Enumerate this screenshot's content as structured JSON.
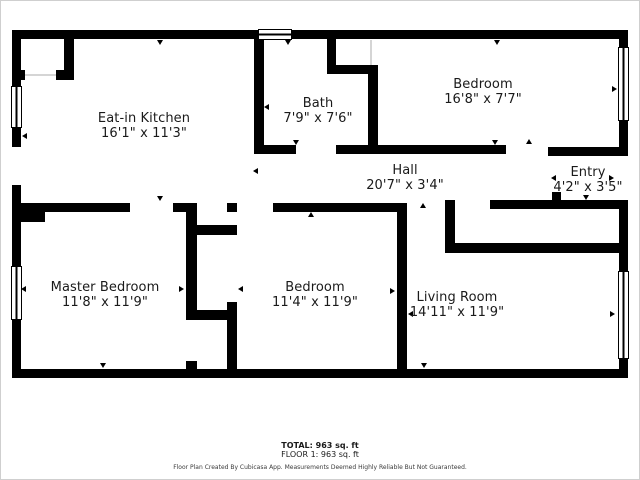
{
  "plan": {
    "rooms": [
      {
        "name": "Eat-in Kitchen",
        "dims": "16'1\" x 11'3\""
      },
      {
        "name": "Bath",
        "dims": "7'9\" x 7'6\""
      },
      {
        "name": "Bedroom",
        "dims": "16'8\" x 7'7\""
      },
      {
        "name": "Hall",
        "dims": "20'7\" x 3'4\""
      },
      {
        "name": "Entry",
        "dims": "4'2\" x 3'5\""
      },
      {
        "name": "Master Bedroom",
        "dims": "11'8\" x 11'9\""
      },
      {
        "name": "Bedroom",
        "dims": "11'4\" x 11'9\""
      },
      {
        "name": "Living Room",
        "dims": "14'11\" x 11'9\""
      }
    ]
  },
  "footer": {
    "total": "TOTAL: 963 sq. ft",
    "floor": "FLOOR 1: 963 sq. ft",
    "disclaimer": "Floor Plan Created By Cubicasa App. Measurements Deemed Highly Reliable But Not Guaranteed."
  },
  "colors": {
    "wall": "#000000",
    "background": "#ffffff",
    "text": "#1a1a1a"
  }
}
